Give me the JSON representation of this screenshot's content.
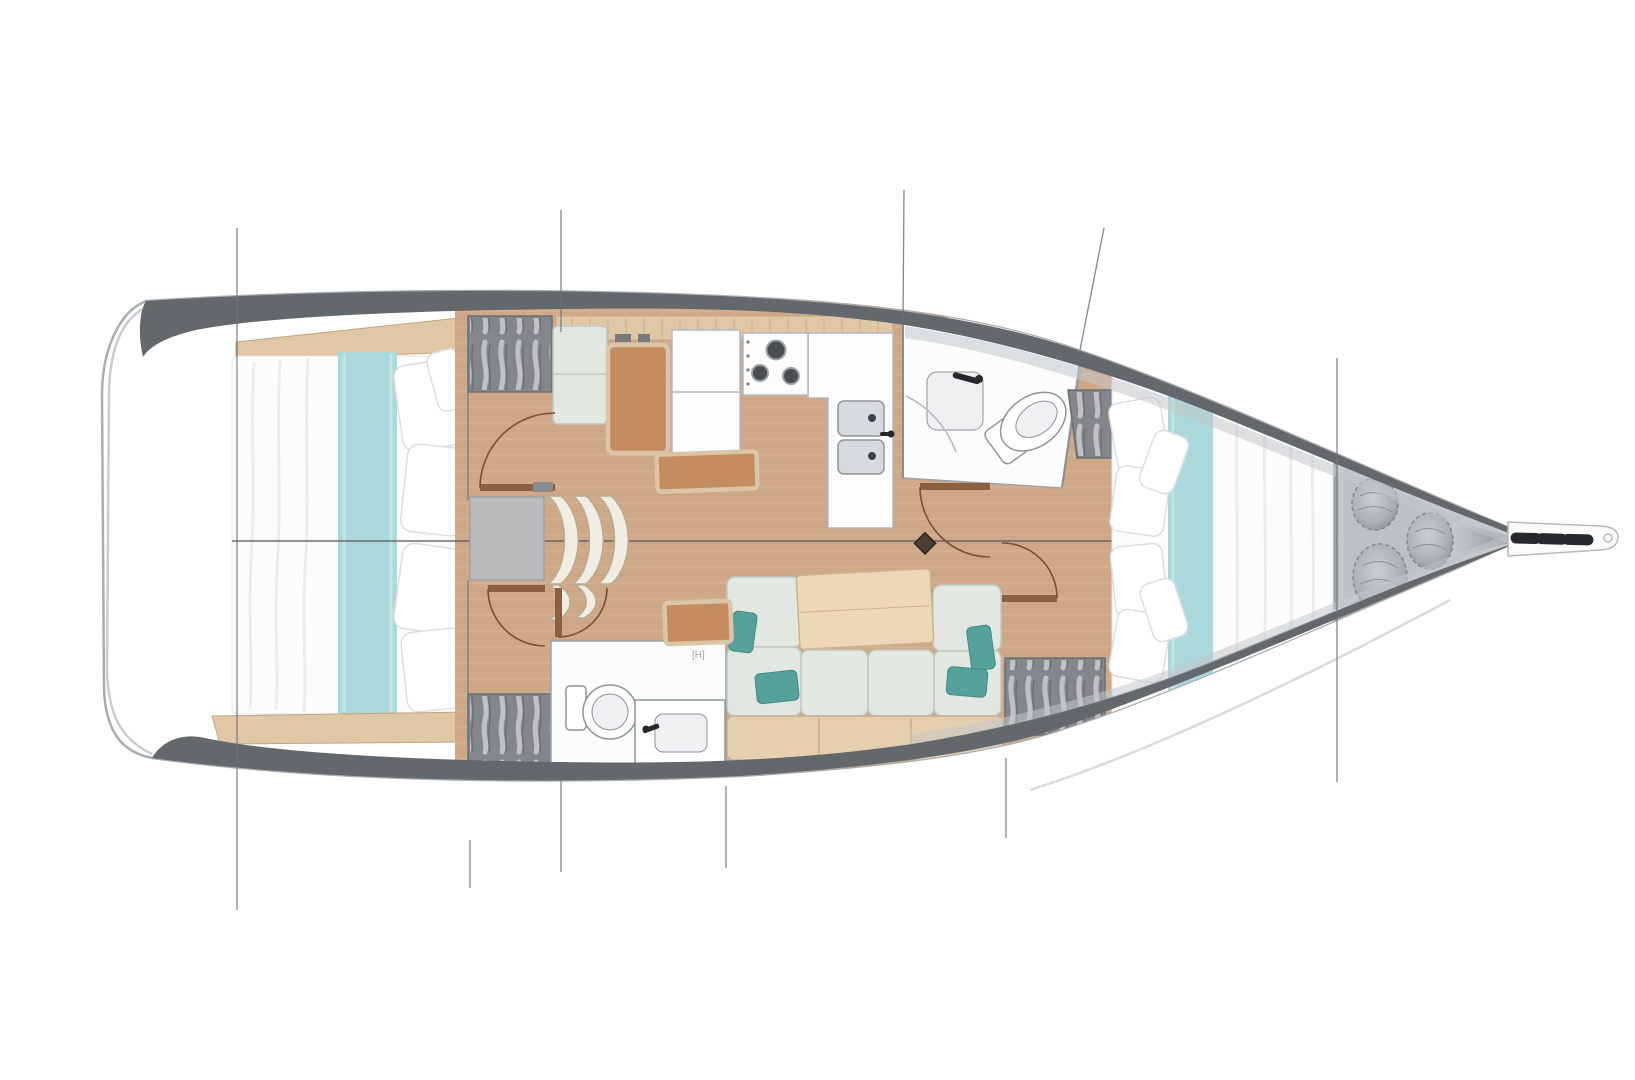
{
  "plan": {
    "type": "sailboat-interior-floor-plan",
    "view": "top-down deck plan",
    "head_mark": "[H]",
    "rooms": [
      "aft-cabin",
      "companionway",
      "nav-station",
      "galley",
      "aft-head",
      "salon",
      "forward-head",
      "forward-cabin",
      "anchor-locker",
      "bow-sprit"
    ]
  },
  "colors": {
    "hull_outline": "#a9adb1",
    "deck_band": "#63686d",
    "bow_wash": "#c3c7ca",
    "wood_floor": "#cfa888",
    "wood_trim": "#e0c7a6",
    "wood_trim_stroke": "#c4a67e",
    "teal_runner": "#abd9db",
    "teal_pillow": "#55a29a",
    "teal_pillow_dark": "#3f948c",
    "sofa_fill": "#e3e7e2",
    "sofa_stroke": "#c2c7c1",
    "sofa_base": "#e6cfae",
    "table_fill": "#ecd8b8",
    "table_stroke": "#cdb28e",
    "bench_fill": "#c58c5f",
    "bench_rim": "#dbc5a7",
    "locker_fill": "#83878b",
    "locker_stroke": "#6b6f73",
    "hanger_light": "#c9ccd0",
    "step_fill": "#f1ede3",
    "step_stroke": "#b6ad94",
    "landing_fill": "#b9bbbc",
    "room_fill": "#fbfcfc",
    "fixture_stroke": "#8f959a",
    "fixture_fill": "#eef0f2",
    "sink_fill": "#d7dadc",
    "burner": "#4a4e52",
    "faucet": "#26292c",
    "anchor_fill": "#c7cacd",
    "coil_stroke": "#82878b",
    "bed_white": "#fcfcfd",
    "pillow_stroke": "#dcdfe2",
    "line": "#6f7276",
    "centerline": "#5d6165",
    "door": "#7a5034",
    "door_leaf": "#8a6040",
    "mast": "#4a3f35"
  }
}
